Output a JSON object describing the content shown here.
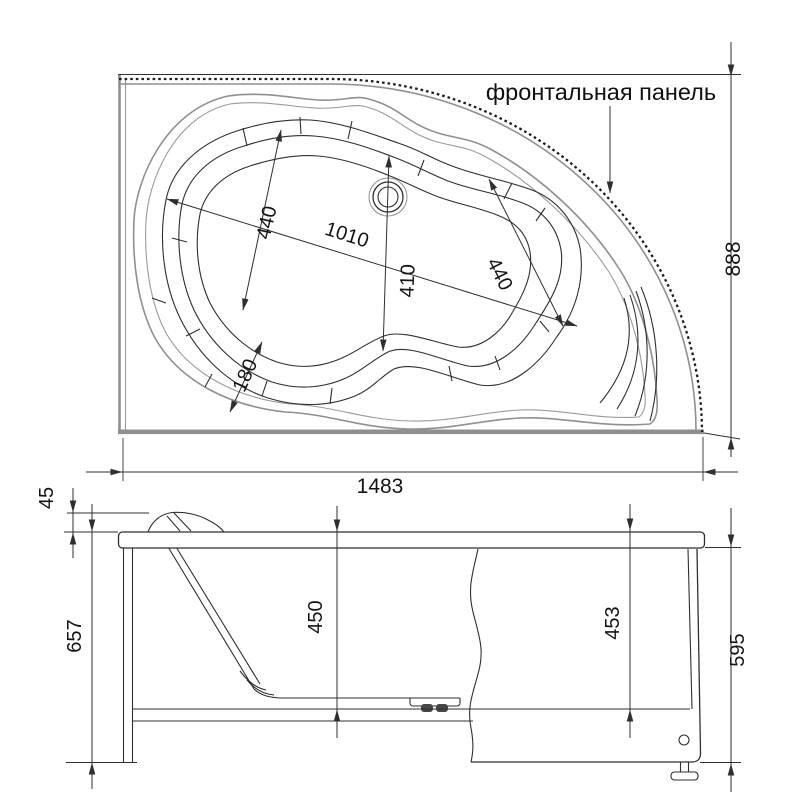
{
  "top_view": {
    "frontal_panel_label": "фронтальная панель",
    "dim_overall_width": "1483",
    "dim_overall_depth": "888",
    "dim_head_end_width": "440",
    "dim_bowl_length": "1010",
    "dim_bowl_mid_width": "410",
    "dim_foot_end_width": "440",
    "dim_corner_ledge": "180"
  },
  "front_view": {
    "dim_rim_lip": "45",
    "dim_overall_height": "657",
    "dim_bowl_depth": "450",
    "dim_panel_height": "453",
    "dim_side_height": "595"
  },
  "colors": {
    "ink": "#2f2f2f",
    "grey": "#8f8f8f",
    "background": "#ffffff"
  }
}
